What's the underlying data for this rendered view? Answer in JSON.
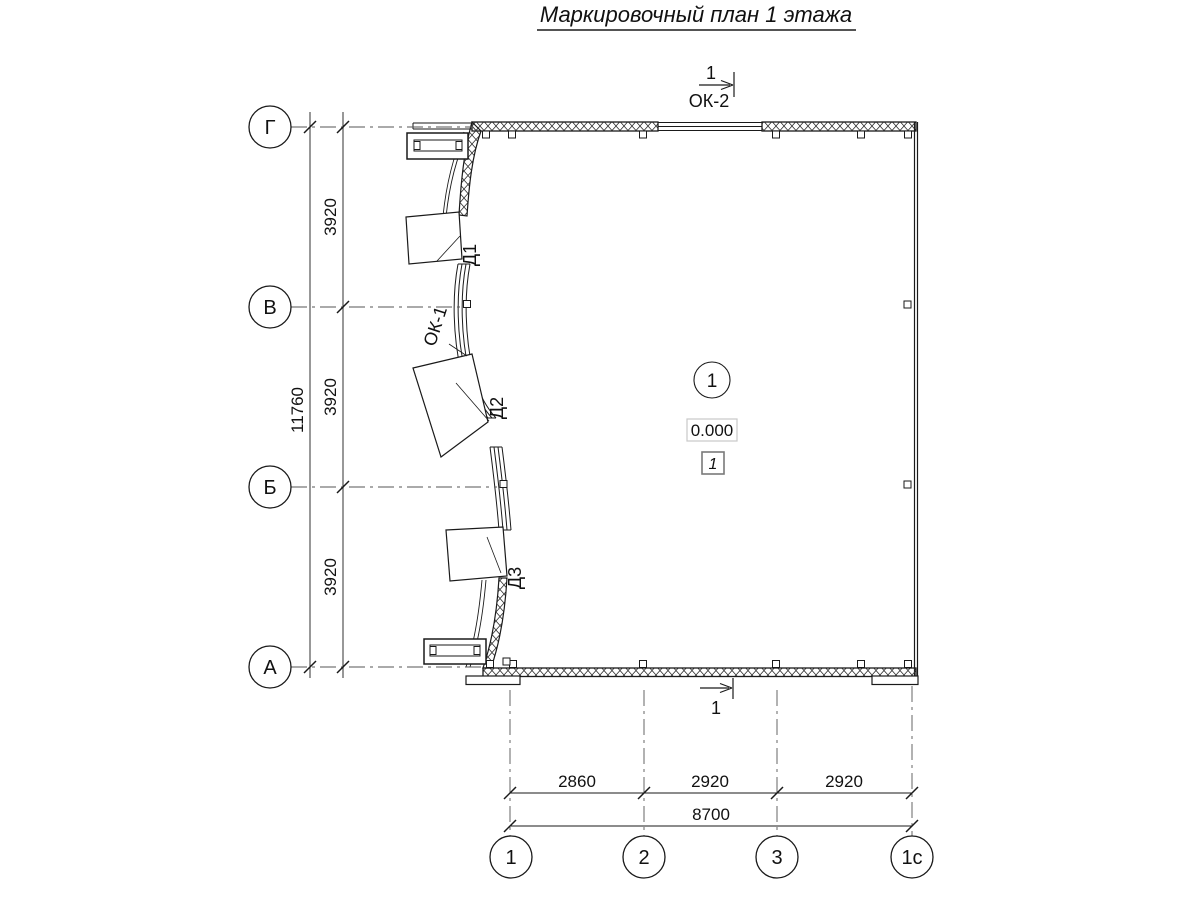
{
  "title": "Маркировочный план 1 этажа",
  "section_top": {
    "number": "1",
    "window": "ОК-2"
  },
  "section_bottom": {
    "number": "1"
  },
  "room": {
    "number": "1",
    "elevation": "0.000",
    "tag": "1"
  },
  "doors": {
    "d1": "Д1",
    "d2": "Д2",
    "d3": "Д3"
  },
  "windows": {
    "ok1": "ОК-1"
  },
  "axes": {
    "rows": [
      "Г",
      "В",
      "Б",
      "А"
    ],
    "cols": [
      "1",
      "2",
      "3",
      "1с"
    ]
  },
  "dims": {
    "left_segments": [
      "3920",
      "3920",
      "3920"
    ],
    "left_total": "11760",
    "bottom_segments": [
      "2860",
      "2920",
      "2920"
    ],
    "bottom_total": "8700"
  },
  "colors": {
    "line": "#1a1a1a",
    "axis_line": "#555555",
    "elevation_box_border": "#c8c8c8",
    "tag_box_border": "#7a7a7a",
    "background": "#ffffff"
  }
}
